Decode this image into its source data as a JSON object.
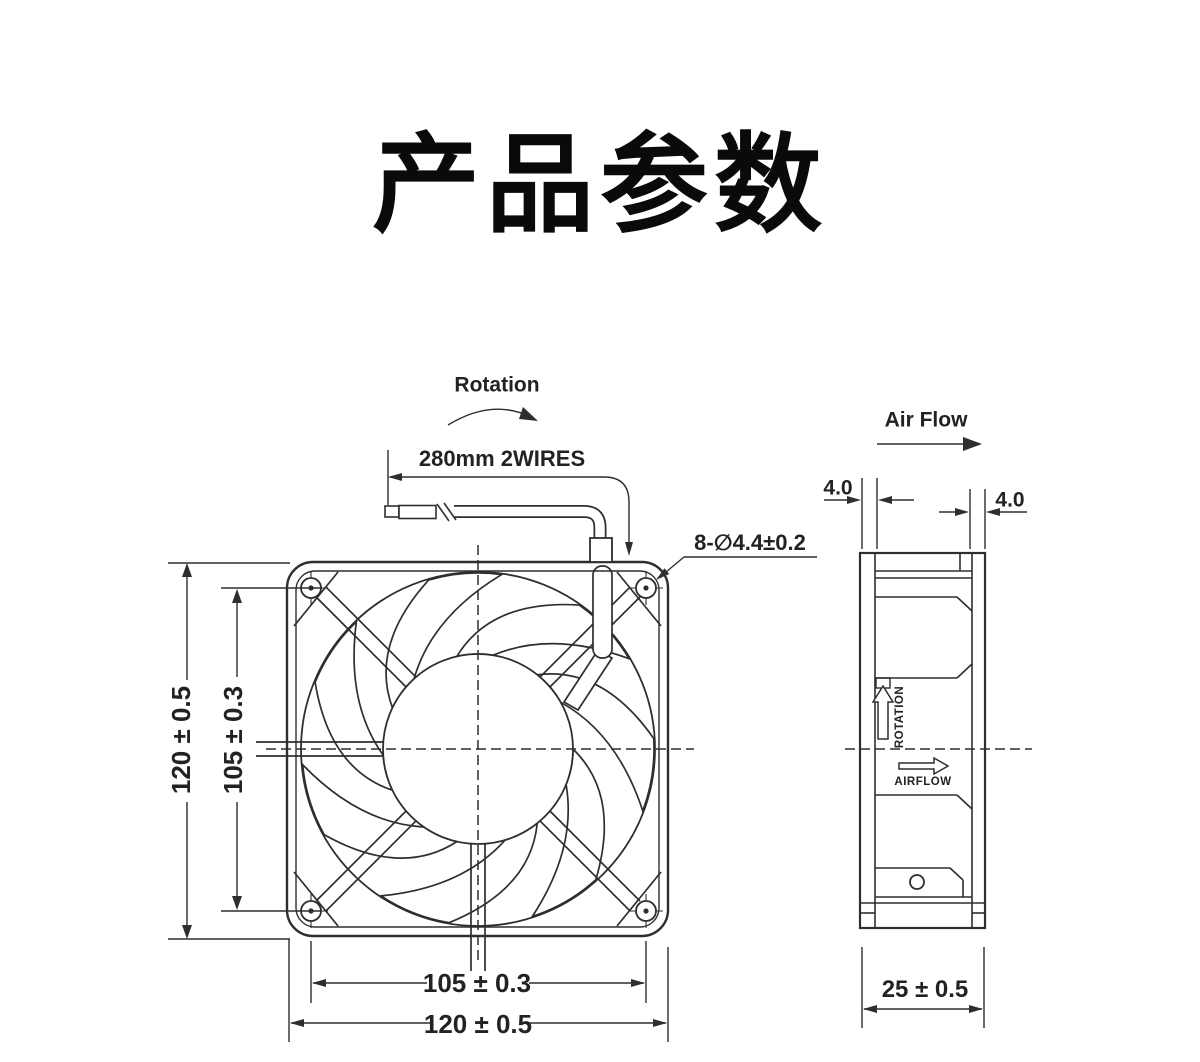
{
  "page": {
    "title": "产品参数"
  },
  "front_view": {
    "rotation_label": "Rotation",
    "wire_label": "280mm 2WIRES",
    "mounting_holes_label": "8-∅4.4±0.2",
    "dim_height_outer": "120 ± 0.5",
    "dim_height_holes": "105 ± 0.3",
    "dim_width_holes": "105 ± 0.3",
    "dim_width_outer": "120 ± 0.5"
  },
  "side_view": {
    "air_flow_label": "Air Flow",
    "flange_front": "4.0",
    "flange_rear": "4.0",
    "rotation_marking": "ROTATION",
    "airflow_marking": "AIRFLOW",
    "dim_depth": "25 ± 0.5"
  }
}
